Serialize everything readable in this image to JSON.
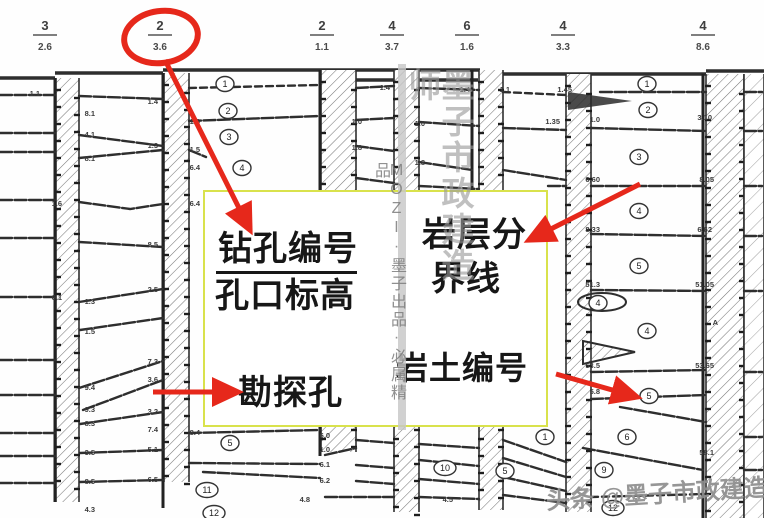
{
  "callout": {
    "borehole_number_label": "钻孔编号",
    "hole_elevation_label": "孔口标高",
    "rock_boundary_line_1": "岩层分",
    "rock_boundary_line_2": "界线",
    "exploration_hole_label": "勘探孔",
    "soil_rock_number_label": "岩土编号",
    "box": {
      "left": 203,
      "top": 190,
      "width": 345,
      "height": 237,
      "border_color": "#d9e24c"
    }
  },
  "watermarks": {
    "vertical_big_text": "墨子市政建造师",
    "vertical_small_text": "MOZI·墨子出品·必属精品",
    "bottom_attribution": "头条 @墨子市政建造师"
  },
  "red_overlay": {
    "color": "#e6281b",
    "ellipse": {
      "cx": 161,
      "cy": 37,
      "rx": 37,
      "ry": 26,
      "rot": -8
    },
    "arrows": [
      {
        "x1": 165,
        "y1": 60,
        "x2": 250,
        "y2": 230,
        "points_at": "borehole-header"
      },
      {
        "x1": 640,
        "y1": 184,
        "x2": 529,
        "y2": 240,
        "points_at": "rock-boundary-label"
      },
      {
        "x1": 153,
        "y1": 392,
        "x2": 238,
        "y2": 392,
        "points_at": "exploration-hole-label"
      },
      {
        "x1": 556,
        "y1": 374,
        "x2": 637,
        "y2": 397,
        "points_at": "stratum-number"
      }
    ]
  },
  "profile": {
    "top_labels": [
      {
        "cx": 45,
        "top": "3",
        "bot": "2.6"
      },
      {
        "cx": 160,
        "top": "2",
        "bot": "3.6",
        "circled": true
      },
      {
        "cx": 322,
        "top": "2",
        "bot": "1.1"
      },
      {
        "cx": 392,
        "top": "4",
        "bot": "3.7"
      },
      {
        "cx": 467,
        "top": "6",
        "bot": "1.6"
      },
      {
        "cx": 563,
        "top": "4",
        "bot": "3.3"
      },
      {
        "cx": 703,
        "top": "4",
        "bot": "8.6"
      }
    ],
    "ground": [
      [
        0,
        78,
        55,
        78
      ],
      [
        55,
        73,
        163,
        73
      ],
      [
        163,
        70,
        480,
        70
      ],
      [
        480,
        74,
        706,
        74
      ],
      [
        706,
        71,
        764,
        71
      ],
      [
        321,
        80,
        478,
        80
      ]
    ],
    "strips": [
      {
        "x0": 56,
        "x1": 79,
        "y0": 78,
        "y1": 502
      },
      {
        "x0": 164,
        "x1": 189,
        "y0": 73,
        "y1": 482
      },
      {
        "x0": 321,
        "x1": 356,
        "y0": 70,
        "y1": 452
      },
      {
        "x0": 394,
        "x1": 419,
        "y0": 70,
        "y1": 512
      },
      {
        "x0": 479,
        "x1": 503,
        "y0": 70,
        "y1": 510
      },
      {
        "x0": 566,
        "x1": 591,
        "y0": 74,
        "y1": 512
      },
      {
        "x0": 706,
        "x1": 744,
        "y0": 74,
        "y1": 518
      },
      {
        "x0": 744,
        "x1": 764,
        "y0": 74,
        "y1": 518,
        "sparse": true
      }
    ],
    "verticals": [
      [
        163,
        73,
        508
      ],
      [
        320,
        70,
        456
      ],
      [
        472,
        70,
        190
      ],
      [
        703,
        74,
        518
      ],
      [
        55,
        78,
        502
      ]
    ],
    "lines": [
      {
        "p": [
          0,
          95,
          56,
          95
        ]
      },
      {
        "p": [
          0,
          133,
          56,
          133
        ]
      },
      {
        "p": [
          0,
          152,
          56,
          152
        ]
      },
      {
        "p": [
          0,
          200,
          56,
          200
        ]
      },
      {
        "p": [
          0,
          238,
          56,
          238
        ]
      },
      {
        "p": [
          0,
          297,
          56,
          297
        ]
      },
      {
        "p": [
          0,
          360,
          56,
          360
        ]
      },
      {
        "p": [
          0,
          395,
          56,
          395
        ]
      },
      {
        "p": [
          0,
          433,
          56,
          433
        ]
      },
      {
        "p": [
          0,
          456,
          56,
          456
        ]
      },
      {
        "p": [
          0,
          483,
          56,
          483
        ]
      },
      {
        "p": [
          79,
          96,
          163,
          99
        ]
      },
      {
        "p": [
          79,
          135,
          163,
          146
        ]
      },
      {
        "p": [
          79,
          158,
          163,
          150
        ]
      },
      {
        "p": [
          79,
          202,
          130,
          209,
          163,
          204
        ]
      },
      {
        "p": [
          79,
          242,
          163,
          247
        ]
      },
      {
        "p": [
          79,
          302,
          163,
          289
        ]
      },
      {
        "p": [
          80,
          330,
          163,
          318
        ]
      },
      {
        "p": [
          79,
          388,
          163,
          361
        ]
      },
      {
        "p": [
          83,
          410,
          163,
          380
        ]
      },
      {
        "p": [
          80,
          424,
          163,
          412
        ]
      },
      {
        "p": [
          80,
          453,
          163,
          450
        ]
      },
      {
        "p": [
          80,
          482,
          163,
          480
        ]
      },
      {
        "p": [
          189,
          88,
          320,
          85
        ],
        "d": 1
      },
      {
        "p": [
          189,
          121,
          320,
          116
        ]
      },
      {
        "p": [
          189,
          150,
          206,
          157
        ]
      },
      {
        "p": [
          189,
          433,
          320,
          430
        ]
      },
      {
        "p": [
          189,
          463,
          320,
          464
        ]
      },
      {
        "p": [
          203,
          472,
          320,
          478
        ]
      },
      {
        "p": [
          356,
          88,
          394,
          86
        ]
      },
      {
        "p": [
          356,
          120,
          394,
          118
        ]
      },
      {
        "p": [
          356,
          146,
          394,
          151
        ]
      },
      {
        "p": [
          356,
          178,
          394,
          183
        ]
      },
      {
        "p": [
          356,
          440,
          394,
          443
        ]
      },
      {
        "p": [
          325,
          455,
          356,
          448
        ]
      },
      {
        "p": [
          356,
          465,
          394,
          468
        ]
      },
      {
        "p": [
          356,
          481,
          394,
          484
        ]
      },
      {
        "p": [
          325,
          497,
          394,
          497
        ]
      },
      {
        "p": [
          419,
          88,
          479,
          90
        ]
      },
      {
        "p": [
          419,
          122,
          479,
          126
        ]
      },
      {
        "p": [
          419,
          162,
          472,
          170
        ]
      },
      {
        "p": [
          419,
          186,
          479,
          189
        ]
      },
      {
        "p": [
          419,
          444,
          479,
          448
        ]
      },
      {
        "p": [
          419,
          460,
          479,
          466
        ]
      },
      {
        "p": [
          419,
          479,
          479,
          484
        ]
      },
      {
        "p": [
          419,
          497,
          479,
          499
        ]
      },
      {
        "p": [
          503,
          92,
          566,
          95
        ],
        "d": 1
      },
      {
        "p": [
          503,
          128,
          566,
          130
        ]
      },
      {
        "p": [
          503,
          170,
          566,
          180
        ]
      },
      {
        "p": [
          503,
          440,
          566,
          462
        ]
      },
      {
        "p": [
          503,
          458,
          566,
          477
        ]
      },
      {
        "p": [
          503,
          477,
          566,
          491
        ]
      },
      {
        "p": [
          503,
          495,
          566,
          503
        ]
      },
      {
        "p": [
          600,
          92,
          706,
          92
        ]
      },
      {
        "p": [
          591,
          128,
          706,
          131
        ]
      },
      {
        "p": [
          548,
          186,
          566,
          186
        ]
      },
      {
        "p": [
          591,
          186,
          706,
          186
        ]
      },
      {
        "p": [
          591,
          234,
          706,
          236
        ]
      },
      {
        "p": [
          591,
          290,
          706,
          291
        ]
      },
      {
        "p": [
          591,
          372,
          706,
          370
        ]
      },
      {
        "p": [
          591,
          399,
          706,
          395
        ]
      },
      {
        "p": [
          620,
          407,
          706,
          422
        ]
      },
      {
        "p": [
          583,
          448,
          703,
          470
        ]
      },
      {
        "p": [
          591,
          497,
          706,
          494
        ],
        "d": 1
      },
      {
        "p": [
          744,
          92,
          762,
          92
        ]
      },
      {
        "p": [
          744,
          131,
          762,
          131
        ]
      },
      {
        "p": [
          744,
          186,
          762,
          186
        ]
      },
      {
        "p": [
          744,
          236,
          762,
          236
        ]
      },
      {
        "p": [
          744,
          291,
          762,
          291
        ]
      },
      {
        "p": [
          744,
          372,
          762,
          372
        ]
      },
      {
        "p": [
          744,
          437,
          762,
          437
        ]
      },
      {
        "p": [
          744,
          470,
          762,
          470
        ]
      }
    ],
    "wedge": [
      [
        568,
        92
      ],
      [
        632,
        101
      ],
      [
        568,
        110
      ]
    ],
    "lens": {
      "cx": 602,
      "cy": 302,
      "rx": 24,
      "ry": 9
    },
    "triangle": [
      [
        583,
        341
      ],
      [
        635,
        352
      ],
      [
        583,
        364
      ]
    ],
    "circles": [
      {
        "x": 225,
        "y": 84,
        "n": "1"
      },
      {
        "x": 228,
        "y": 111,
        "n": "2"
      },
      {
        "x": 229,
        "y": 137,
        "n": "3"
      },
      {
        "x": 242,
        "y": 168,
        "n": "4"
      },
      {
        "x": 230,
        "y": 443,
        "n": "5"
      },
      {
        "x": 207,
        "y": 490,
        "n": "11"
      },
      {
        "x": 214,
        "y": 513,
        "n": "12"
      },
      {
        "x": 445,
        "y": 468,
        "n": "10"
      },
      {
        "x": 505,
        "y": 471,
        "n": "5"
      },
      {
        "x": 545,
        "y": 437,
        "n": "1"
      },
      {
        "x": 647,
        "y": 84,
        "n": "1"
      },
      {
        "x": 648,
        "y": 110,
        "n": "2"
      },
      {
        "x": 639,
        "y": 157,
        "n": "3"
      },
      {
        "x": 639,
        "y": 211,
        "n": "4"
      },
      {
        "x": 639,
        "y": 266,
        "n": "5"
      },
      {
        "x": 647,
        "y": 331,
        "n": "4"
      },
      {
        "x": 598,
        "y": 303,
        "n": "4"
      },
      {
        "x": 649,
        "y": 396,
        "n": "5"
      },
      {
        "x": 627,
        "y": 437,
        "n": "6"
      },
      {
        "x": 604,
        "y": 470,
        "n": "9"
      },
      {
        "x": 613,
        "y": 508,
        "n": "12"
      }
    ],
    "tiny_labels": [
      {
        "x": 40,
        "y": 96,
        "t": "1.1"
      },
      {
        "x": 95,
        "y": 116,
        "t": "8.1"
      },
      {
        "x": 95,
        "y": 137,
        "t": "4.1"
      },
      {
        "x": 95,
        "y": 161,
        "t": "8.1"
      },
      {
        "x": 62,
        "y": 206,
        "t": "1.6"
      },
      {
        "x": 62,
        "y": 300,
        "t": "6.1"
      },
      {
        "x": 95,
        "y": 304,
        "t": "1.3"
      },
      {
        "x": 95,
        "y": 334,
        "t": "1.5"
      },
      {
        "x": 95,
        "y": 390,
        "t": "9.4"
      },
      {
        "x": 95,
        "y": 412,
        "t": "9.3"
      },
      {
        "x": 95,
        "y": 426,
        "t": "8.3"
      },
      {
        "x": 95,
        "y": 455,
        "t": "3.5"
      },
      {
        "x": 95,
        "y": 484,
        "t": "8.5"
      },
      {
        "x": 95,
        "y": 512,
        "t": "4.3"
      },
      {
        "x": 158,
        "y": 104,
        "t": "1.4"
      },
      {
        "x": 158,
        "y": 148,
        "t": "1.3"
      },
      {
        "x": 200,
        "y": 124,
        "t": "1.6"
      },
      {
        "x": 200,
        "y": 152,
        "t": "1.5"
      },
      {
        "x": 200,
        "y": 170,
        "t": "6.4"
      },
      {
        "x": 200,
        "y": 206,
        "t": "6.4"
      },
      {
        "x": 158,
        "y": 247,
        "t": "8.5"
      },
      {
        "x": 158,
        "y": 292,
        "t": "2.5"
      },
      {
        "x": 158,
        "y": 364,
        "t": "7.3"
      },
      {
        "x": 158,
        "y": 382,
        "t": "3.6"
      },
      {
        "x": 158,
        "y": 414,
        "t": "3.2"
      },
      {
        "x": 158,
        "y": 432,
        "t": "7.4"
      },
      {
        "x": 158,
        "y": 452,
        "t": "5.1"
      },
      {
        "x": 158,
        "y": 482,
        "t": "6.5"
      },
      {
        "x": 200,
        "y": 435,
        "t": "8.4"
      },
      {
        "x": 330,
        "y": 438,
        "t": "6.0"
      },
      {
        "x": 330,
        "y": 452,
        "t": "1.0"
      },
      {
        "x": 330,
        "y": 467,
        "t": "6.1"
      },
      {
        "x": 330,
        "y": 483,
        "t": "6.2"
      },
      {
        "x": 310,
        "y": 502,
        "t": "4.8"
      },
      {
        "x": 453,
        "y": 502,
        "t": "4.5"
      },
      {
        "x": 362,
        "y": 124,
        "t": "1.0"
      },
      {
        "x": 362,
        "y": 150,
        "t": "1.8"
      },
      {
        "x": 390,
        "y": 90,
        "t": "1.4"
      },
      {
        "x": 425,
        "y": 126,
        "t": "1.0"
      },
      {
        "x": 425,
        "y": 165,
        "t": "1.8"
      },
      {
        "x": 470,
        "y": 92,
        "t": "1.4"
      },
      {
        "x": 510,
        "y": 92,
        "t": "1.1"
      },
      {
        "x": 560,
        "y": 124,
        "t": "1.35"
      },
      {
        "x": 572,
        "y": 92,
        "t": "1.45"
      },
      {
        "x": 600,
        "y": 122,
        "t": "1.0"
      },
      {
        "x": 600,
        "y": 182,
        "t": "6.60"
      },
      {
        "x": 600,
        "y": 232,
        "t": "8.33"
      },
      {
        "x": 600,
        "y": 287,
        "t": "51.3"
      },
      {
        "x": 600,
        "y": 368,
        "t": "53.5"
      },
      {
        "x": 600,
        "y": 394,
        "t": "5.8"
      },
      {
        "x": 712,
        "y": 120,
        "t": "3.10"
      },
      {
        "x": 714,
        "y": 182,
        "t": "8.05"
      },
      {
        "x": 712,
        "y": 232,
        "t": "6.62"
      },
      {
        "x": 714,
        "y": 287,
        "t": "51.05"
      },
      {
        "x": 718,
        "y": 325,
        "t": "A"
      },
      {
        "x": 714,
        "y": 368,
        "t": "53.65"
      },
      {
        "x": 714,
        "y": 455,
        "t": "58.1"
      }
    ]
  },
  "colors": {
    "ink": "#2e2e2e",
    "hatch": "#6a6a6a",
    "red": "#e6281b",
    "yellow_box": "#d9e24c"
  }
}
